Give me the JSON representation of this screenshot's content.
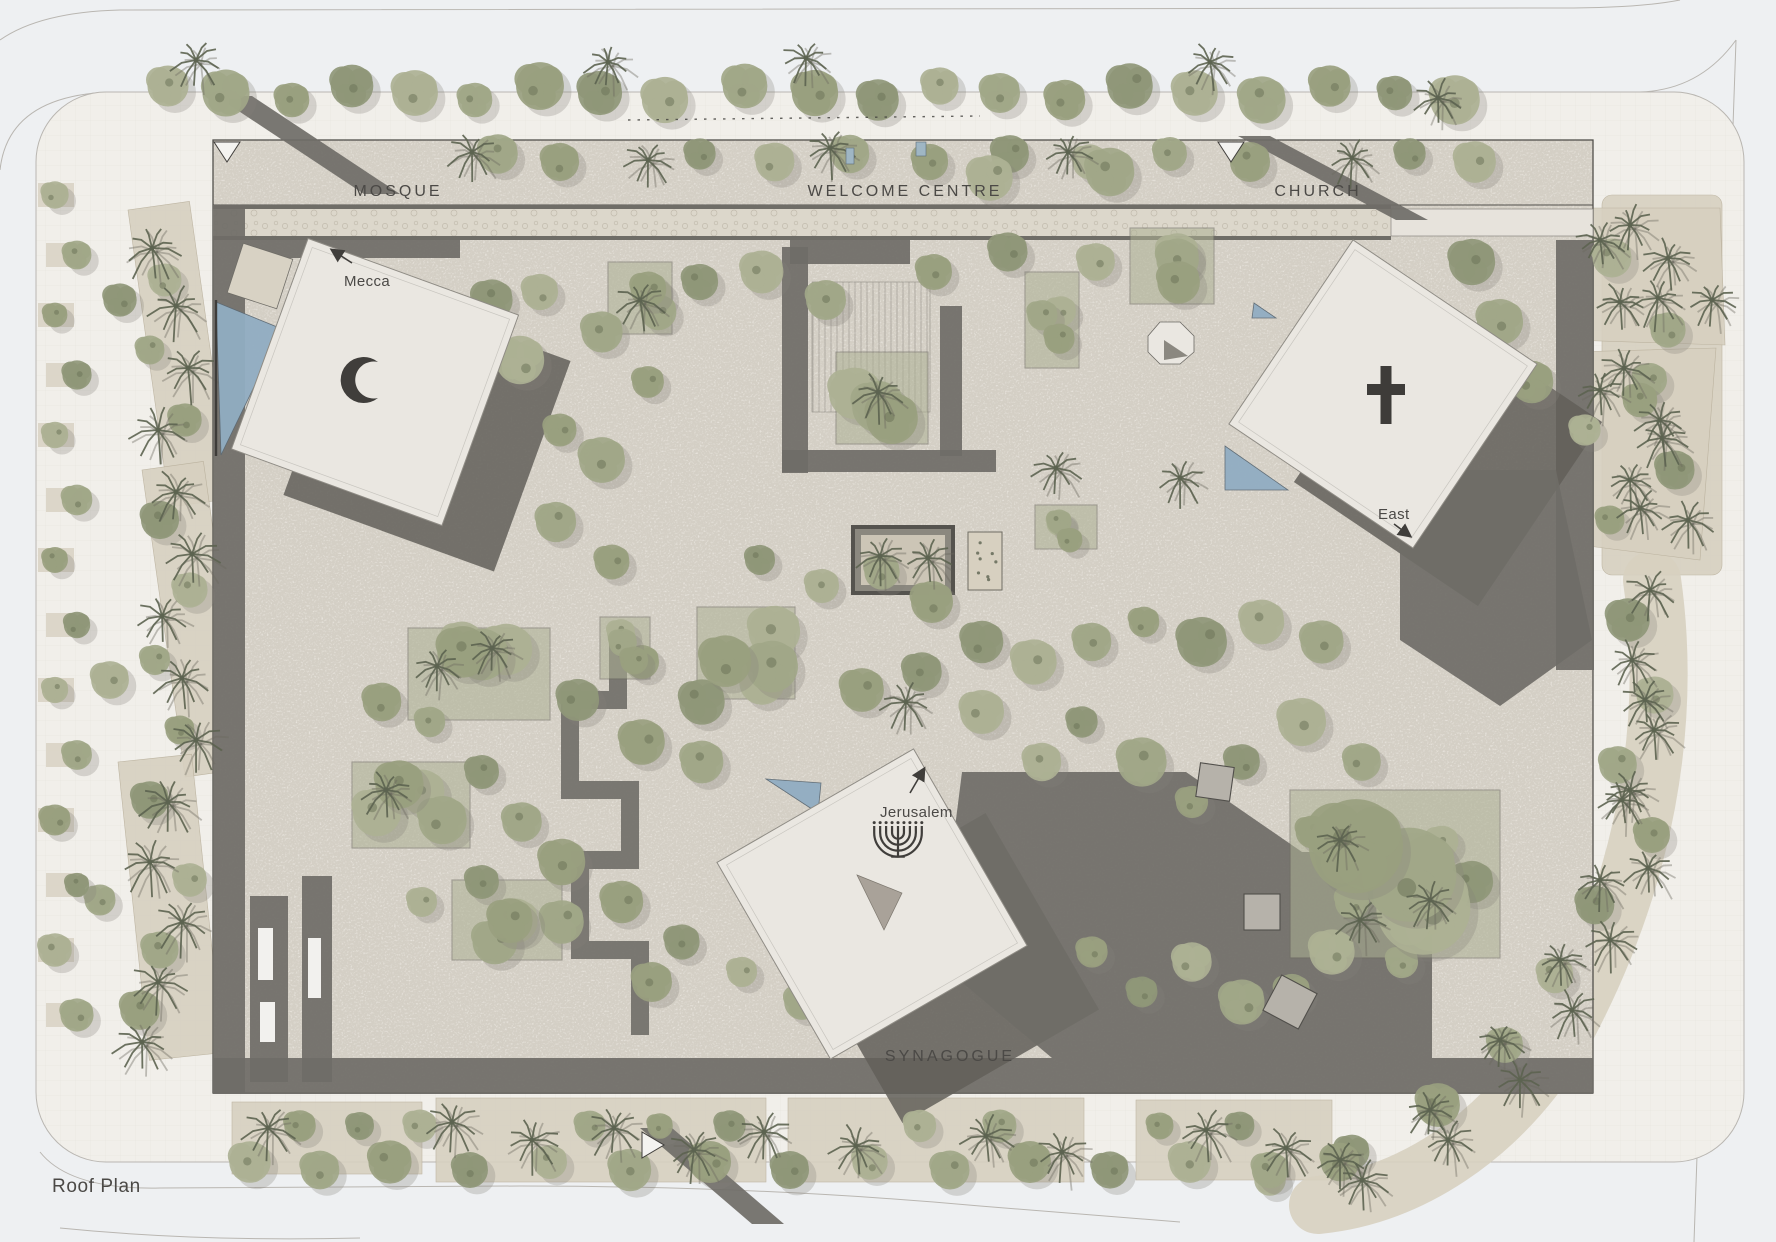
{
  "plan": {
    "drawing_label": "Roof Plan",
    "labels": {
      "mosque": "MOSQUE",
      "welcome_centre": "WELCOME CENTRE",
      "church": "CHURCH",
      "synagogue": "SYNAGOGUE",
      "mecca": "Mecca",
      "east": "East",
      "jerusalem": "Jerusalem"
    },
    "symbols": {
      "mosque": "crescent-icon",
      "church": "cross-icon",
      "synagogue": "menorah-icon"
    },
    "colors": {
      "page_bg": "#eef0f2",
      "sidewalk": "#f1efea",
      "sidewalk_line": "#b9b6b1",
      "plaza": "#e7e3dc",
      "plaza_speckle": "#b8b2a4",
      "walkway_dark": "#6f6d67",
      "shadow_dark": "#615f59",
      "roof_white": "#eae7e1",
      "roof_edge": "#8f8c85",
      "bed_beige": "#d7d0c0",
      "pebble": "#dcd7cb",
      "tree_greens": [
        "#adb194",
        "#a1a788",
        "#99a07f",
        "#8f9778"
      ],
      "tree_dark": "#6e7459",
      "palm_dark": "#5c6350",
      "water_blue": "#91adc2",
      "ink": "#403e3b",
      "label_gray": "#4b4946"
    }
  }
}
